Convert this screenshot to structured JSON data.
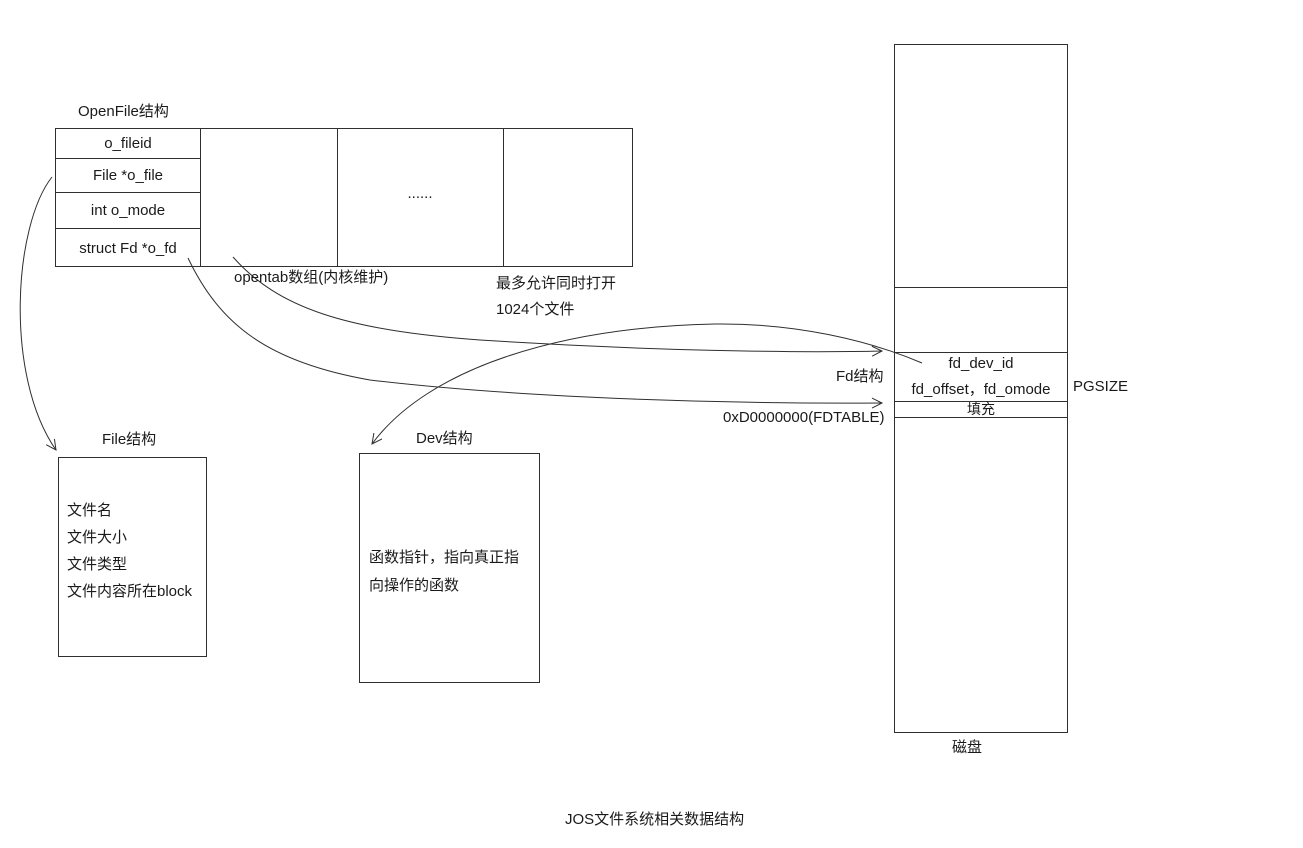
{
  "diagram": {
    "title": "JOS文件系统相关数据结构",
    "openfile": {
      "label": "OpenFile结构",
      "fields": [
        "o_fileid",
        "File *o_file",
        "int o_mode",
        "struct Fd *o_fd"
      ],
      "ellipsis": "......",
      "caption": "opentab数组(内核维护)",
      "note": {
        "line1": "最多允许同时打开",
        "line2": "1024个文件"
      }
    },
    "file_struct": {
      "label": "File结构",
      "fields": [
        "文件名",
        "文件大小",
        "文件类型",
        "文件内容所在block"
      ]
    },
    "dev_struct": {
      "label": "Dev结构",
      "lines": [
        "函数指针，指向真正指",
        "向操作的函数"
      ]
    },
    "disk": {
      "label": "磁盘",
      "fd_struct_label": "Fd结构",
      "rows": [
        "fd_dev_id",
        "fd_offset，fd_omode",
        "填充"
      ],
      "pgsize_label": "PGSIZE",
      "fdtable_label": "0xD0000000(FDTABLE)"
    },
    "colors": {
      "stroke": "#2f2f2f",
      "text": "#1a1a1a",
      "background": "#ffffff"
    }
  }
}
